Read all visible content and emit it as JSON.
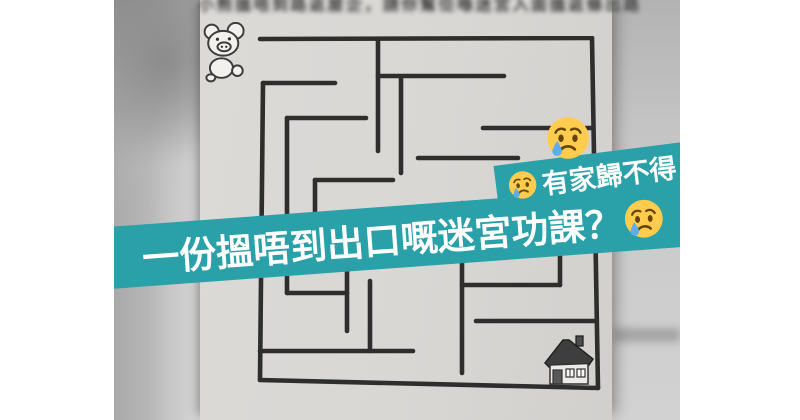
{
  "overlay": {
    "banner_color": "#2aa0a8",
    "text_color": "#ffffff",
    "main_line": {
      "text": "一份搵唔到出口嘅迷宮功課？",
      "trailing_emoji": "crying-face"
    },
    "small_line": {
      "leading_emoji": "crying-face",
      "text": "有家歸不得"
    },
    "floating_emoji": "crying-face"
  },
  "emoji_colors": {
    "face": "#FFCC4D",
    "features": "#664500",
    "tear": "#5DADEC"
  },
  "worksheet": {
    "instruction_text_blurred": "小熊搵唔到路返屋企，請你幫佢喺迷宮入面搵返條出路啦！",
    "start_marker": "pig-cartoon",
    "goal_marker": "house-drawing",
    "maze": {
      "wall_color": "#2e2e2e",
      "stroke_width": 4.6,
      "walls": [
        [
          4,
          3,
          336,
          2
        ],
        [
          336,
          2,
          342,
          352
        ],
        [
          4,
          344,
          342,
          352
        ],
        [
          7,
          47,
          4,
          344
        ],
        [
          122,
          3,
          122,
          115
        ],
        [
          122,
          40,
          248,
          40
        ],
        [
          145,
          42,
          145,
          137
        ],
        [
          7,
          47,
          79,
          47
        ],
        [
          31,
          82,
          110,
          82
        ],
        [
          31,
          82,
          31,
          257
        ],
        [
          31,
          257,
          91,
          257
        ],
        [
          91,
          214,
          91,
          295
        ],
        [
          59,
          144,
          137,
          144
        ],
        [
          59,
          144,
          59,
          207
        ],
        [
          162,
          122,
          262,
          122
        ],
        [
          227,
          92,
          336,
          92
        ],
        [
          206,
          167,
          206,
          337
        ],
        [
          206,
          249,
          304,
          249
        ],
        [
          304,
          202,
          304,
          249
        ],
        [
          220,
          285,
          339,
          285
        ],
        [
          4,
          315,
          157,
          315
        ],
        [
          114,
          245,
          114,
          315
        ]
      ]
    }
  }
}
